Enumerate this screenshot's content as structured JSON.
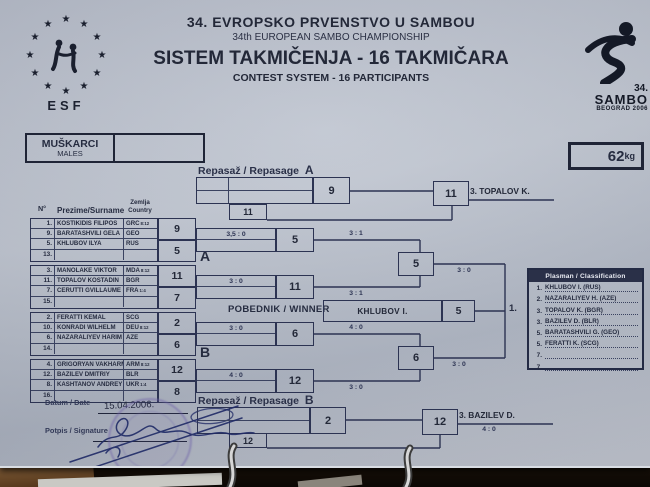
{
  "colors": {
    "ink": "#262c40",
    "line": "#2c3352",
    "paper": "#bcc2cd",
    "class_header_bg": "#2a3048",
    "stamp": "#6c60a8"
  },
  "header": {
    "title_sr": "34.  EVROPSKO  PRVENSTVO  U  SAMBOU",
    "title_en": "34th  EUROPEAN  SAMBO  CHAMPIONSHIP",
    "subtitle_sr": "SISTEM TAKMIČENJA - 16 TAKMIČARA",
    "subtitle_en": "CONTEST SYSTEM - 16 PARTICIPANTS",
    "esf_label": "ESF",
    "event_logo": {
      "number": "34.",
      "name": "SAMBO",
      "city": "BEOGRAD 2006"
    }
  },
  "category_box": {
    "line1": "MUŠKARCI",
    "line2": "MALES"
  },
  "weight_box": {
    "value": "62",
    "unit": "kg"
  },
  "repasage_a": {
    "label": "Repasaž / Repasage",
    "letter": "A",
    "first_winner": "9",
    "loser_entrant": "11",
    "final_winner": "11",
    "place": "3. TOPALOV K."
  },
  "repasage_b": {
    "label": "Repasaž / Repasage",
    "letter": "B",
    "first_winner": "2",
    "loser_entrant": "12",
    "final_winner": "12",
    "place": "3. BAZILEV D.",
    "score": "4 : 0"
  },
  "table": {
    "col_no": "N°",
    "col_name": "Prezime/Surname",
    "col_country_1": "Zemlja",
    "col_country_2": "Country",
    "rows": [
      {
        "no": "1.",
        "name": "KOSTIKIDIS FILIPOS",
        "country": "GRC",
        "note": "8:12"
      },
      {
        "no": "9.",
        "name": "BARATASHVILI GELA",
        "country": "GEO",
        "note": ""
      },
      {
        "no": "5.",
        "name": "KHLUBOV ILYA",
        "country": "RUS",
        "note": ""
      },
      {
        "no": "13.",
        "name": "",
        "country": "",
        "note": ""
      },
      {
        "no": "3.",
        "name": "MANOLAKE VIKTOR",
        "country": "MDA",
        "note": "8:12"
      },
      {
        "no": "11.",
        "name": "TOPALOV KOSTADIN",
        "country": "BGR",
        "note": ""
      },
      {
        "no": "7.",
        "name": "CERUTTI GVILLAUME",
        "country": "FRA",
        "note": "1:4"
      },
      {
        "no": "15.",
        "name": "",
        "country": "",
        "note": ""
      },
      {
        "no": "2.",
        "name": "FERATTI KEMAL",
        "country": "SCG",
        "note": ""
      },
      {
        "no": "10.",
        "name": "KONRADI WILHELM",
        "country": "DEU",
        "note": "8:12"
      },
      {
        "no": "6.",
        "name": "NAZARALIYEV HARIM",
        "country": "AZE",
        "note": ""
      },
      {
        "no": "14.",
        "name": "",
        "country": "",
        "note": ""
      },
      {
        "no": "4.",
        "name": "GRIGORYAN VAKHARM",
        "country": "ARM",
        "note": "8:12"
      },
      {
        "no": "12.",
        "name": "BAZILEV DMITRIY",
        "country": "BLR",
        "note": ""
      },
      {
        "no": "8.",
        "name": "KASHTANOV ANDREY",
        "country": "UKR",
        "note": "1:4"
      },
      {
        "no": "16.",
        "name": "",
        "country": "",
        "note": ""
      }
    ],
    "winner_boxes": [
      "9",
      "5",
      "11",
      "7",
      "2",
      "6",
      "12",
      "8"
    ]
  },
  "bracket": {
    "group_a_label": "A",
    "group_b_label": "B",
    "a_qf1_score": "3,5 : 0",
    "a_qf1_winner": "5",
    "a_qf2_score": "3 : 0",
    "a_qf2_winner": "11",
    "a_sf_top_score": "3 : 1",
    "a_sf_bottom_score": "3 : 1",
    "a_sf_winner": "5",
    "a_final_score": "3 : 0",
    "b_qf1_score": "3 : 0",
    "b_qf1_winner": "6",
    "b_qf2_score": "4 : 0",
    "b_qf2_winner": "12",
    "b_sf_top_score": "4 : 0",
    "b_sf_bottom_score": "3 : 0",
    "b_sf_winner": "6",
    "b_final_score": "3 : 0",
    "winner_label": "POBEDNIK / WINNER",
    "winner_name": "KHLUBOV I.",
    "winner_number": "5",
    "first_place": "1."
  },
  "classification": {
    "title": "Plasman / Classification",
    "rows": [
      {
        "rank": "1.",
        "entry": "KHLUBOV I. (RUS)"
      },
      {
        "rank": "2.",
        "entry": "NAZARALIYEV H. (AZE)"
      },
      {
        "rank": "3.",
        "entry": "TOPALOV K. (BGR)"
      },
      {
        "rank": "3.",
        "entry": "BAZILEV D. (BLR)"
      },
      {
        "rank": "5.",
        "entry": "BARATASHVILI G. (GEO)"
      },
      {
        "rank": "5.",
        "entry": "FERATTI K. (SCG)"
      },
      {
        "rank": "7.",
        "entry": ""
      },
      {
        "rank": "7.",
        "entry": ""
      }
    ]
  },
  "footer": {
    "date_label": "Datum / Date",
    "date_value": "15.04.2006.",
    "signature_label": "Potpis / Signature"
  }
}
